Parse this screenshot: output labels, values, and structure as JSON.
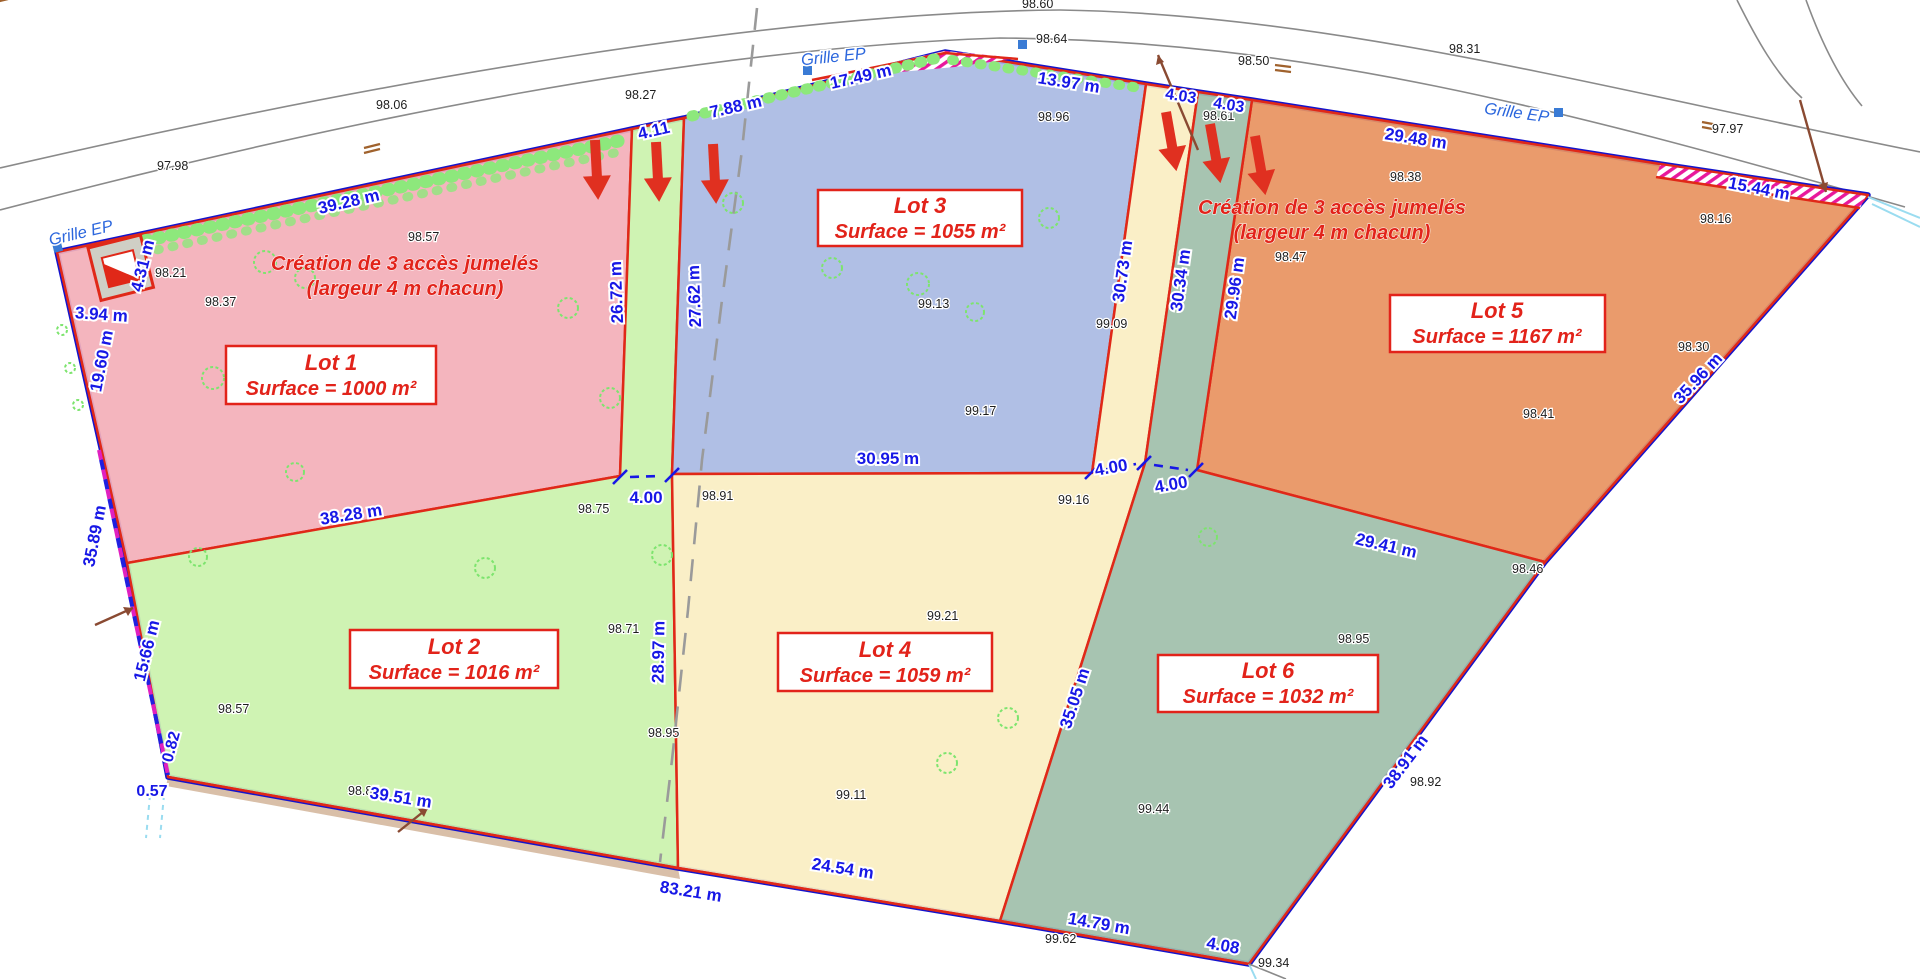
{
  "plan": {
    "street_label": "Grille EP",
    "lots": [
      {
        "name": "Lot 1",
        "surface": "Surface = 1000 m²",
        "color": "#f3afb8"
      },
      {
        "name": "Lot 2",
        "surface": "Surface = 1016 m²",
        "color": "#cbf2ad"
      },
      {
        "name": "Lot 3",
        "surface": "Surface = 1055 m²",
        "color": "#a9bae3"
      },
      {
        "name": "Lot 4",
        "surface": "Surface = 1059 m²",
        "color": "#faeec2"
      },
      {
        "name": "Lot 5",
        "surface": "Surface = 1167 m²",
        "color": "#e89260"
      },
      {
        "name": "Lot 6",
        "surface": "Surface = 1032 m²",
        "color": "#9fbfaa"
      }
    ],
    "annotation_left": {
      "line1": "Création de 3 accès jumelés",
      "line2": "(largeur 4 m chacun)"
    },
    "annotation_right": {
      "line1": "Création de 3 accès jumelés",
      "line2": "(largeur 4 m chacun)"
    },
    "dimensions": [
      "39.28 m",
      "4.11",
      "7.88 m",
      "17.49 m",
      "13.97 m",
      "4.03",
      "4.03",
      "29.48 m",
      "15.44 m",
      "35.96 m",
      "29.41 m",
      "38.91 m",
      "4.08",
      "14.79 m",
      "24.54 m",
      "83.21 m",
      "39.51 m",
      "0.57",
      "0.82",
      "15.66 m",
      "35.89 m",
      "19.60 m",
      "4.31 m",
      "3.94 m",
      "38.28 m",
      "4.00",
      "30.95 m",
      "4.00",
      "4.00",
      "26.72 m",
      "27.62 m",
      "28.97 m",
      "30.73 m",
      "30.34 m",
      "29.96 m",
      "35.05 m"
    ],
    "elevations": [
      "97.98",
      "98.06",
      "98.27",
      "98.64",
      "98.50",
      "98.31",
      "98.60",
      "97.97",
      "98.21",
      "98.57",
      "98.37",
      "98.48",
      "98.75",
      "98.91",
      "98.96",
      "99.13",
      "99.17",
      "99.09",
      "98.61",
      "98.38",
      "98.47",
      "98.16",
      "98.41",
      "98.30",
      "98.46",
      "98.95",
      "98.92",
      "99.44",
      "99.62",
      "99.34",
      "98.85",
      "98.57",
      "98.71",
      "98.95",
      "99.21",
      "99.11",
      "99.16"
    ]
  }
}
